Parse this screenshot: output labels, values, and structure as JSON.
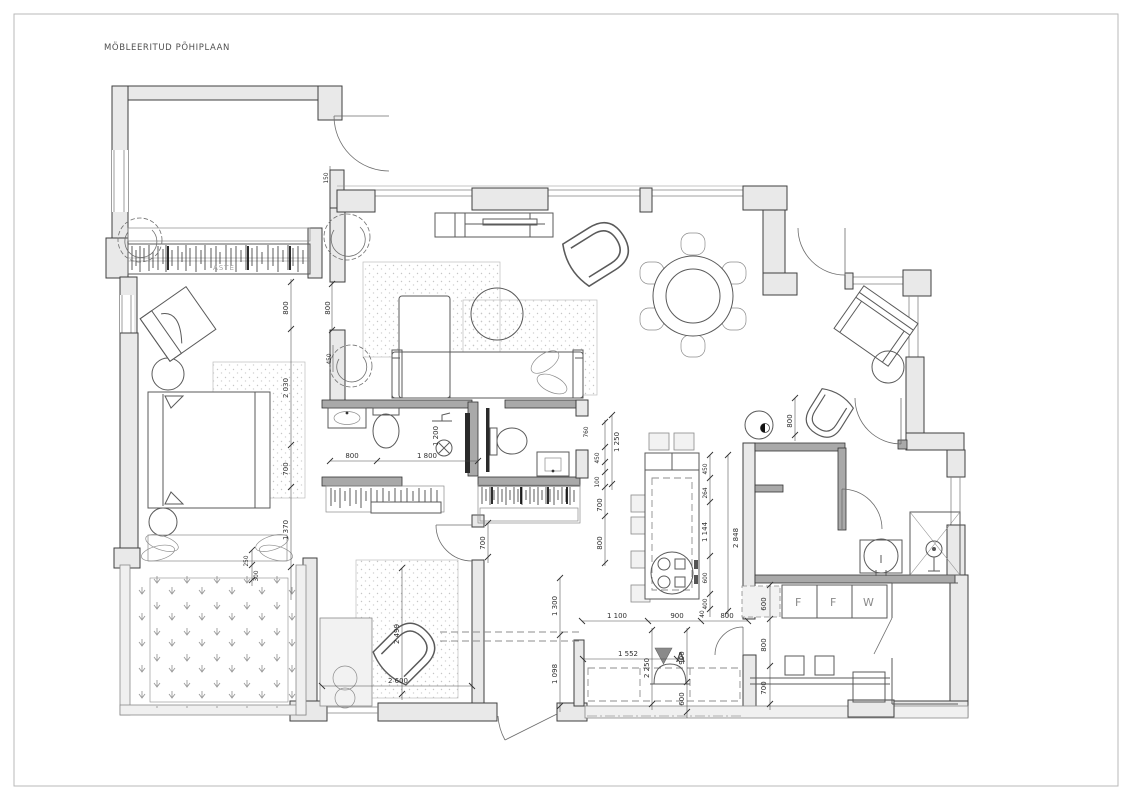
{
  "page": {
    "title": "MÖBLEERITUD PÕHIPLAAN"
  },
  "plan": {
    "labels": {
      "wardrobe": "ASTE",
      "section_marker": "A",
      "appliance_f1": "F",
      "appliance_f2": "F",
      "appliance_w": "W"
    },
    "colors": {
      "wall_fill": "#e9e9e9",
      "wall_line": "#3f3f3f",
      "dim_text": "#2e2e2e"
    },
    "dimensions": {
      "bedroom_door_800": "800",
      "bedroom_2030": "2 030",
      "bedroom_700": "700",
      "bedroom_1370": "1 370",
      "bench_250": "250",
      "bench_300": "300",
      "living_door_800": "800",
      "loggia_150": "150",
      "living_450": "450",
      "bath_800": "800",
      "bath_1800": "1 800",
      "bath_1200": "1 200",
      "hall_760": "760",
      "hall_1250": "1 250",
      "hall_450": "450",
      "hall_100": "100",
      "hall_700": "700",
      "hall_800": "800",
      "corridor_700": "700",
      "entry_1300": "1 300",
      "entry_1098": "1 098",
      "room2_2499": "2 499",
      "room2_2600": "2 600",
      "kitchen_1100": "1 100",
      "kitchen_900": "900",
      "kitchen_800": "800",
      "entry_2250": "2 250",
      "entry_900": "900",
      "entry_1552": "1 552",
      "entry_600": "600",
      "island_450": "450",
      "island_264": "264",
      "island_1144": "1 144",
      "island_600": "600",
      "island_400": "400",
      "island_40": "40",
      "island_2848": "2 848",
      "util_800": "800",
      "util_600": "600",
      "util_800b": "800",
      "util_700": "700"
    }
  }
}
